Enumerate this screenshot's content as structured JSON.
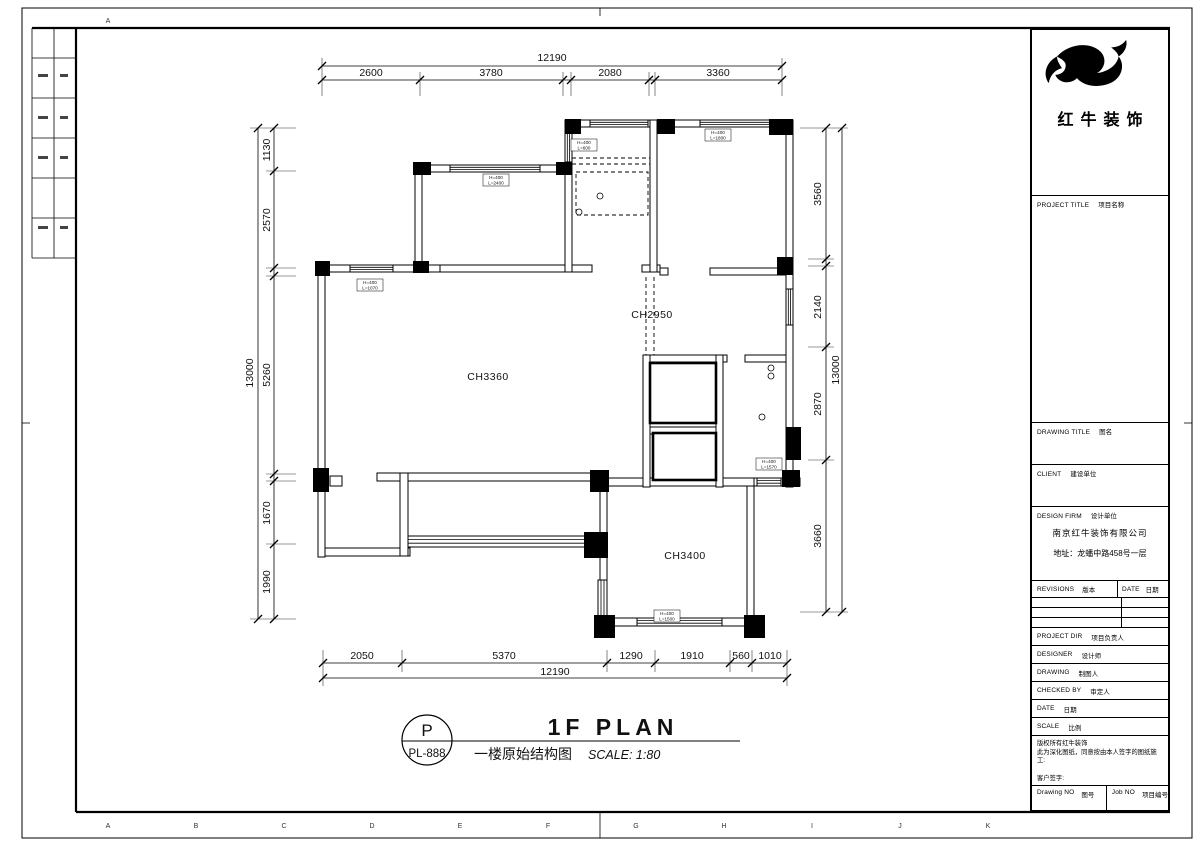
{
  "colors": {
    "line": "#000000",
    "paper": "#ffffff"
  },
  "brand": {
    "name": "红牛装饰"
  },
  "sheet": {
    "top_edge_letter": "A",
    "bottom_edge_letters": [
      "A",
      "B",
      "C",
      "D",
      "E",
      "F",
      "G",
      "H",
      "I",
      "J",
      "K"
    ]
  },
  "plan": {
    "rooms": {
      "living": "CH3360",
      "dining": "CH2950",
      "bedroom": "CH3400"
    },
    "window_tags": [
      {
        "l1": "H=400",
        "l2": "L=2400"
      },
      {
        "l1": "H=400",
        "l2": "L=1070"
      },
      {
        "l1": "H=400",
        "l2": "L=600"
      },
      {
        "l1": "H=400",
        "l2": "L=1800"
      },
      {
        "l1": "H=400",
        "l2": "L=1570"
      },
      {
        "l1": "H=400",
        "l2": "L=1500"
      }
    ]
  },
  "dimensions": {
    "top": {
      "overall": "12190",
      "segments": [
        "2600",
        "3780",
        "2080",
        "3360"
      ]
    },
    "bottom": {
      "overall": "12190",
      "segments": [
        "2050",
        "5370",
        "1290",
        "1910",
        "560",
        "1010"
      ]
    },
    "left": {
      "overall": "13000",
      "segments": [
        "1130",
        "2570",
        "5260",
        "1670",
        "1990"
      ]
    },
    "right": {
      "overall": "13000",
      "segments": [
        "3560",
        "2140",
        "2870",
        "3660"
      ]
    }
  },
  "plan_title": {
    "bubble_letter": "P",
    "sheet_no": "PL-888",
    "title_en": "1F PLAN",
    "title_cn": "一楼原始结构图",
    "scale_note": "SCALE: 1:80"
  },
  "title_block": {
    "project": {
      "en": "PROJECT TITLE",
      "cn": "项目名称"
    },
    "drawing_title": {
      "en": "DRAWING TITLE",
      "cn": "图名"
    },
    "client": {
      "en": "CLIENT",
      "cn": "建设单位"
    },
    "design_firm": {
      "en": "DESIGN FIRM",
      "cn": "设计单位"
    },
    "company": "南京红牛装饰有限公司",
    "address": "地址：龙蟠中路458号一层",
    "revisions": {
      "en": "REVISIONS",
      "cn": "版本"
    },
    "date_col": {
      "en": "DATE",
      "cn": "日期"
    },
    "rows": [
      {
        "en": "PROJECT DIR",
        "cn": "项目负责人"
      },
      {
        "en": "DESIGNER",
        "cn": "设计师"
      },
      {
        "en": "DRAWING",
        "cn": "制图人"
      },
      {
        "en": "CHECKED BY",
        "cn": "审定人"
      },
      {
        "en": "DATE",
        "cn": "日期"
      },
      {
        "en": "SCALE",
        "cn": "比例"
      }
    ],
    "copyright": [
      "版权所有红牛装饰",
      "此为深化图纸，同意按由本人签字的图纸施工:",
      "客户签字:"
    ],
    "drawing_no": {
      "en": "Drawing NO",
      "cn": "图号"
    },
    "job_no": {
      "en": "Job NO",
      "cn": "项目编号"
    }
  }
}
